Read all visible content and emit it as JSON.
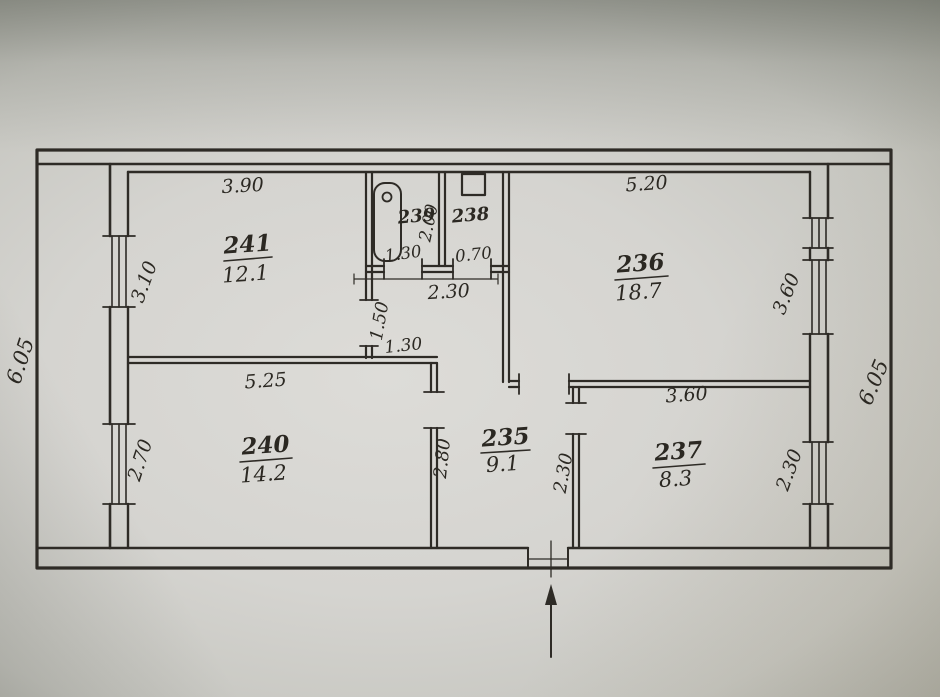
{
  "plan": {
    "rooms": {
      "r241": {
        "number": "241",
        "area": "12.1"
      },
      "r239": {
        "number": "239"
      },
      "r238": {
        "number": "238"
      },
      "r236": {
        "number": "236",
        "area": "18.7"
      },
      "r240": {
        "number": "240",
        "area": "14.2"
      },
      "r235": {
        "number": "235",
        "area": "9.1"
      },
      "r237": {
        "number": "237",
        "area": "8.3"
      }
    },
    "dims": {
      "room241_width": "3.90",
      "room236_width": "5.20",
      "room241_window": "3.10",
      "room240_window": "2.70",
      "building_left_height": "6.05",
      "building_right_height": "6.05",
      "room236_window": "3.60",
      "room237_window": "2.30",
      "bath_wall_height": "2.00",
      "bath_width": "1.30",
      "wc_width": "0.70",
      "corridor_width": "2.30",
      "nook_height": "1.50",
      "nook_width": "1.30",
      "room240_width": "5.25",
      "hall_height": "2.80",
      "hall_wall": "2.30",
      "room237_width": "3.60"
    },
    "icons": {
      "bathtub": "bathtub",
      "toilet": "toilet-cistern",
      "entrance_arrow": "entrance-direction-arrow"
    },
    "colors": {
      "ink": "#2e2b26",
      "paper_light": "#dddcd8",
      "paper_dark": "#979890"
    }
  }
}
